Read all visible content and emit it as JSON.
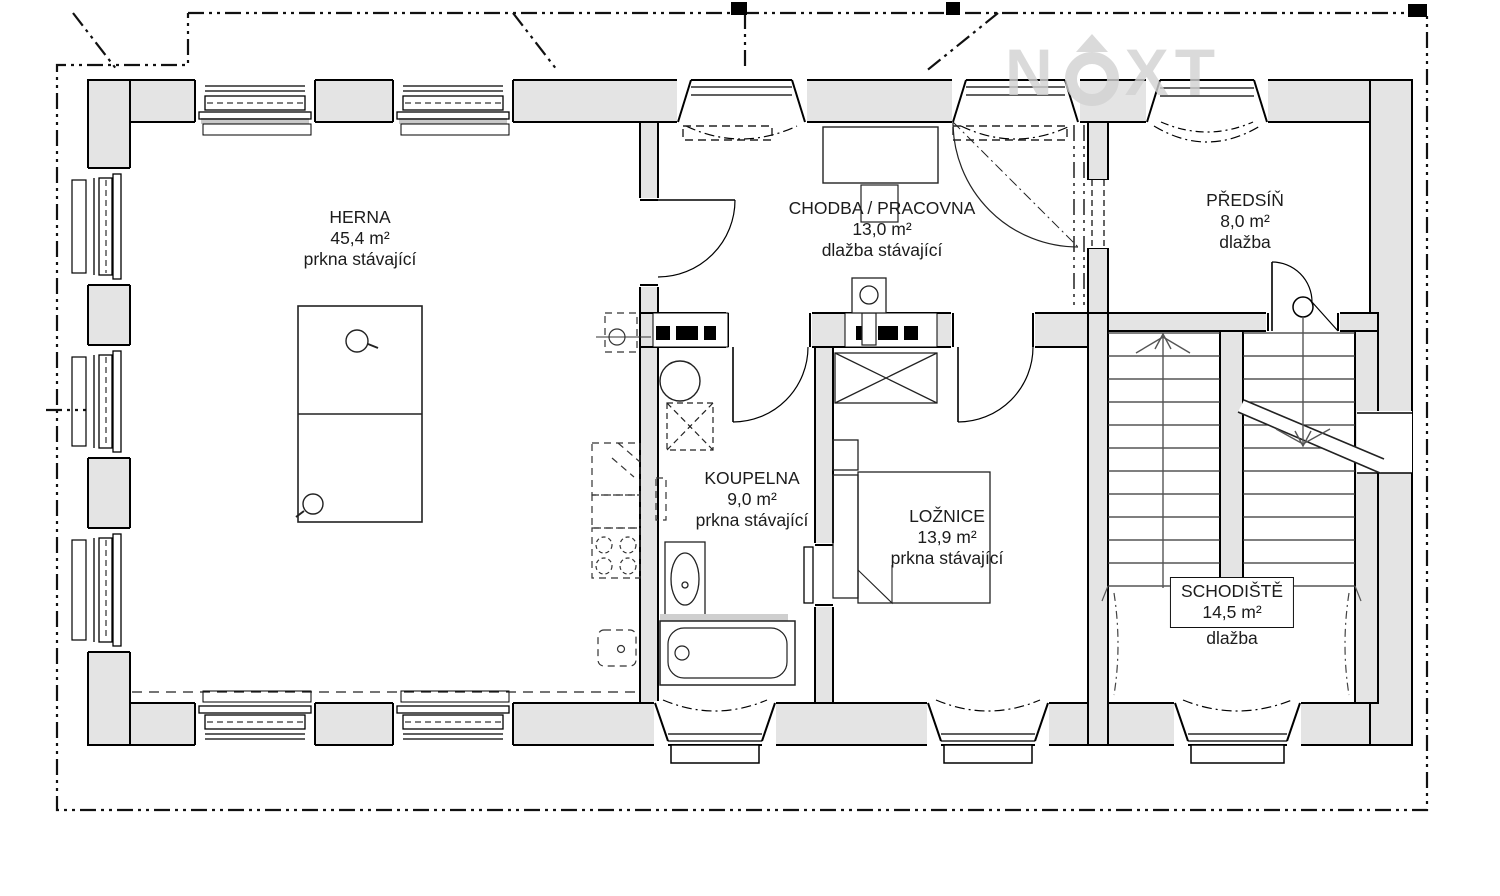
{
  "plan": {
    "rooms": [
      {
        "id": "herna",
        "name": "HERNA",
        "area": "45,4 m²",
        "floor": "prkna stávající"
      },
      {
        "id": "chodba-pracovna",
        "name": "CHODBA / PRACOVNA",
        "area": "13,0 m²",
        "floor": "dlažba stávající"
      },
      {
        "id": "predsin",
        "name": "PŘEDSÍŇ",
        "area": "8,0 m²",
        "floor": "dlažba"
      },
      {
        "id": "koupelna",
        "name": "KOUPELNA",
        "area": "9,0 m²",
        "floor": "prkna stávající"
      },
      {
        "id": "loznice",
        "name": "LOŽNICE",
        "area": "13,9 m²",
        "floor": "prkna stávající"
      },
      {
        "id": "schodiste",
        "name": "SCHODIŠTĚ",
        "area": "14,5 m²",
        "floor": "dlažba"
      }
    ],
    "watermark": {
      "part1": "N",
      "part2": "XT",
      "full": "NEXT"
    }
  }
}
